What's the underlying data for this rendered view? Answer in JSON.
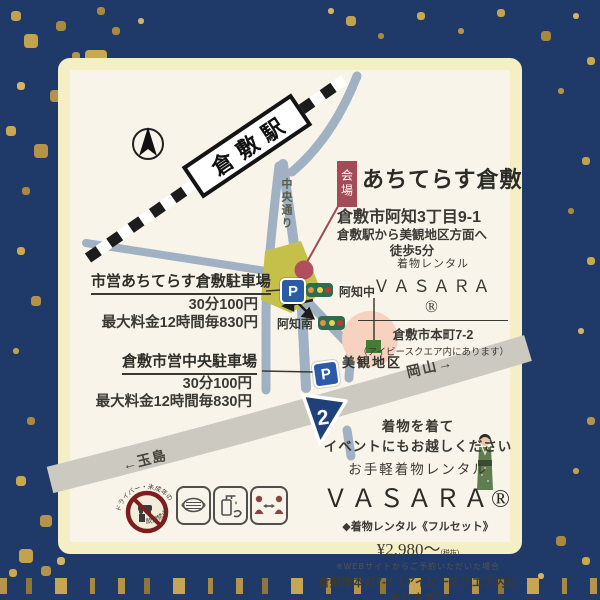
{
  "colors": {
    "background_navy": "#1f3a69",
    "gold": "#c2a14d",
    "card_border": "#f5efc6",
    "card_bg": "#f8f4e9",
    "road_blue": "#9fb1c3",
    "road_highway": "#cbc9c0",
    "venue_block_green": "#c5c049",
    "venue_marker_red": "#b14f5e",
    "kaijo_box_red": "#a34b56",
    "parking_sign_blue": "#2b5aa6",
    "pink_highlight": "#f6d2bf",
    "bikan_marker_green": "#447c35",
    "route_shield_navy": "#20407a",
    "signal_body_green": "#2f6b50",
    "signal_orange": "#e2923c",
    "signal_yellow": "#e8d34b",
    "signal_red": "#bf3b31"
  },
  "map": {
    "station_label": "倉敷駅",
    "chuo_dori_label": "中央通り",
    "kaijo_tag": "会場",
    "venue_name": "あちてらす倉敷",
    "venue_address": "倉敷市阿知3丁目9-1",
    "venue_access_line1": "倉敷駅から美観地区方面へ",
    "venue_access_line2": "徒歩5分",
    "parking1": {
      "name": "市営あちてらす倉敷駐車場",
      "price1": "30分100円",
      "price2": "最大料金12時間毎830円"
    },
    "parking2": {
      "name": "倉敷市営中央駐車場",
      "price1": "30分100円",
      "price2": "最大料金12時間毎830円"
    },
    "parking_sign": "P",
    "signal_north": "阿知中",
    "signal_south": "阿知南",
    "bikan_label": "美観地区",
    "route_number": "2",
    "okayama_label": "岡山→",
    "tamashima_label": "←玉島",
    "vasara": {
      "heading": "着物レンタル",
      "brand": "ＶＡＳＡＲＡ®",
      "address": "倉敷市本町7-2",
      "note": "（アイビースクエア内にあります）"
    }
  },
  "promo": {
    "line1": "着物を着て",
    "line2": "イベントにもお越しください",
    "line3": "お手軽着物レンタル",
    "brand": "ＶＡＳＡＲＡ®",
    "price_prefix": "◆着物レンタル《フルセット》",
    "price": "¥2,980〜",
    "price_note": "(税抜)",
    "web_note": "※WEBサイトからご予約いただいた場合",
    "address": "倉敷市本町7-2（アイビースクエア内にあります）",
    "tel": "お問い合わせ TEL:03-5577-5882"
  },
  "covid": {
    "no_drink_top": "ドライバー・未成年の",
    "no_drink_bottom": "飲酒禁止"
  }
}
